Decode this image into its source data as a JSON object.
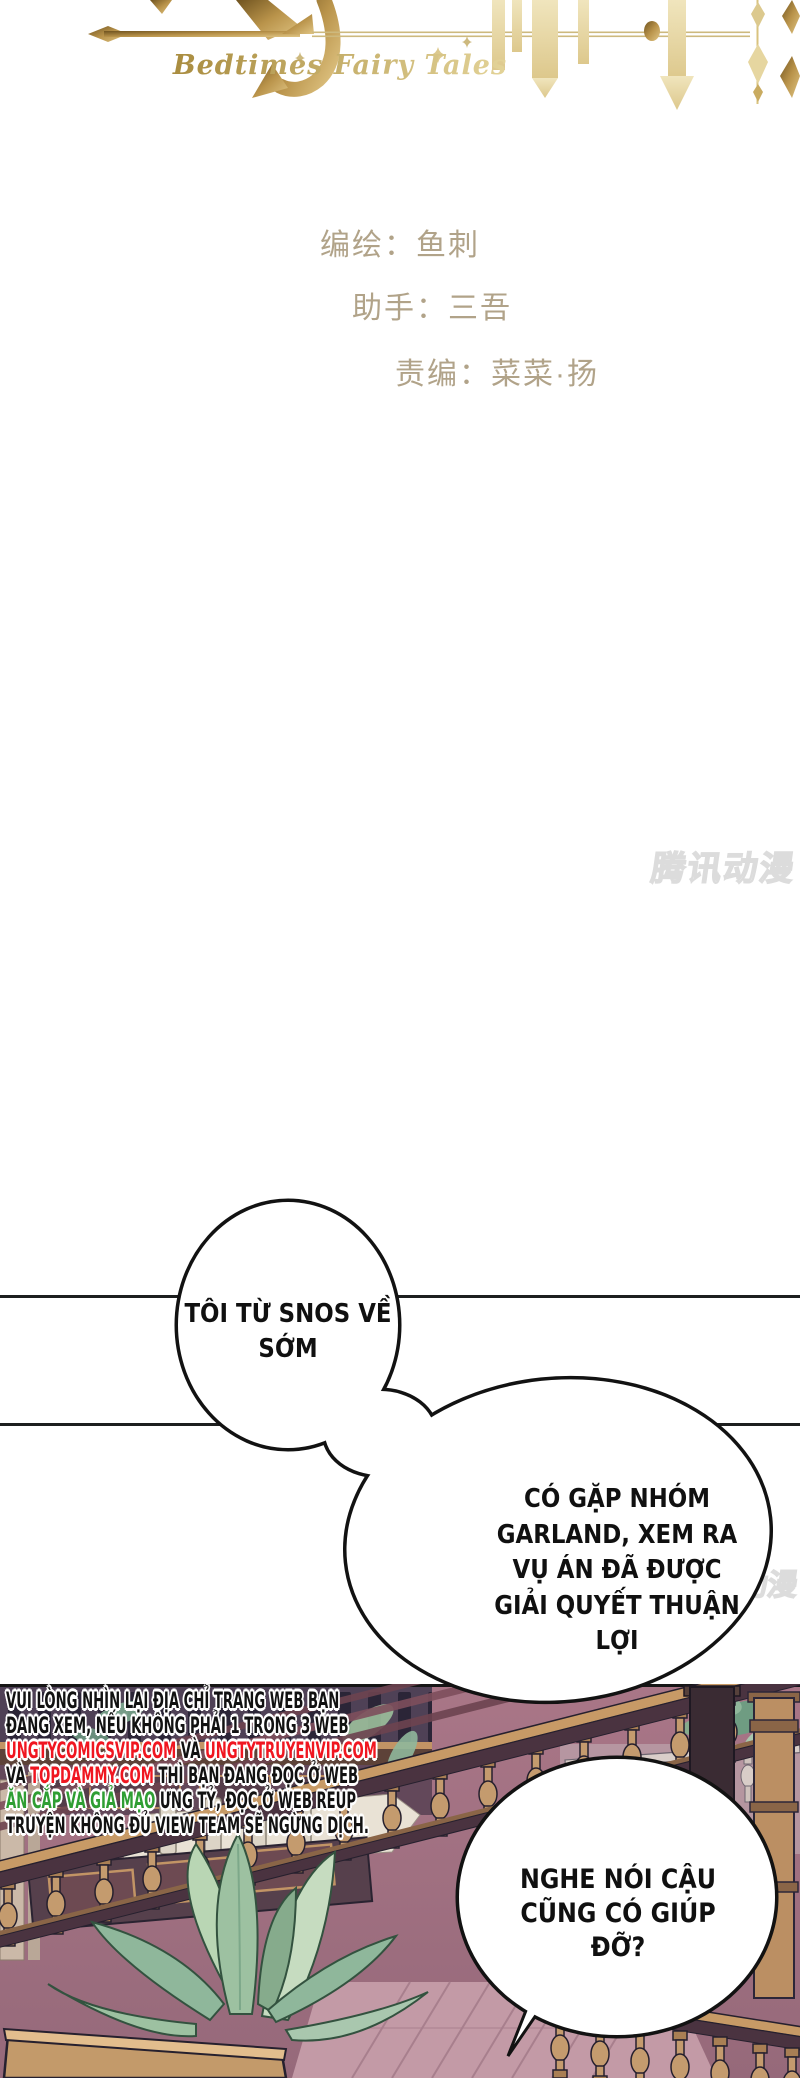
{
  "logo": {
    "subtitle": "Bedtimes Fairy Tales",
    "gold": "#b9934a"
  },
  "credits": {
    "artist": "编绘：鱼刺",
    "assistant": "助手：三吾",
    "editor": "责编：菜菜·扬",
    "color": "#b1a389"
  },
  "watermarks": {
    "main": "腾讯动漫",
    "fragment": "动漫"
  },
  "speech": {
    "bubble1": {
      "lines": [
        "TÔI TỪ SNOS VỀ",
        "SỚM"
      ]
    },
    "bubble2": {
      "lines": [
        "CÓ GẶP NHÓM",
        "GARLAND, XEM RA",
        "VỤ ÁN ĐÃ ĐƯỢC",
        "GIẢI QUYẾT THUẬN",
        "LỢI"
      ]
    },
    "bubble3": {
      "lines": [
        "NGHE NÓI CẬU",
        "CŨNG CÓ GIÚP",
        "ĐỠ?"
      ]
    }
  },
  "warning": {
    "line1": "VUI LÒNG NHÌN LẠI ĐỊA CHỈ TRANG WEB BẠN",
    "line2": "ĐANG XEM, NẾU KHÔNG PHẢI 1 TRONG 3 WEB",
    "line3a": "UNGTYCOMICSVIP.COM",
    "line3b": " VÀ ",
    "line3c": "UNGTYTRUYENVIP.COM",
    "line4a": "VÀ ",
    "line4b": "TOPDAMMY.COM",
    "line4c": " THÌ BẠN ĐANG ĐỌC Ở WEB",
    "line5a": "ĂN CẮP VÀ GIẢ MẠO",
    "line5b": " ƯNG TỶ, ĐỌC Ở WEB REUP",
    "line6": "TRUYỆN KHÔNG ĐỦ VIEW TEAM SẼ NGỪNG DỊCH.",
    "link_color": "#f01620",
    "alert_color": "#2f9e33"
  }
}
